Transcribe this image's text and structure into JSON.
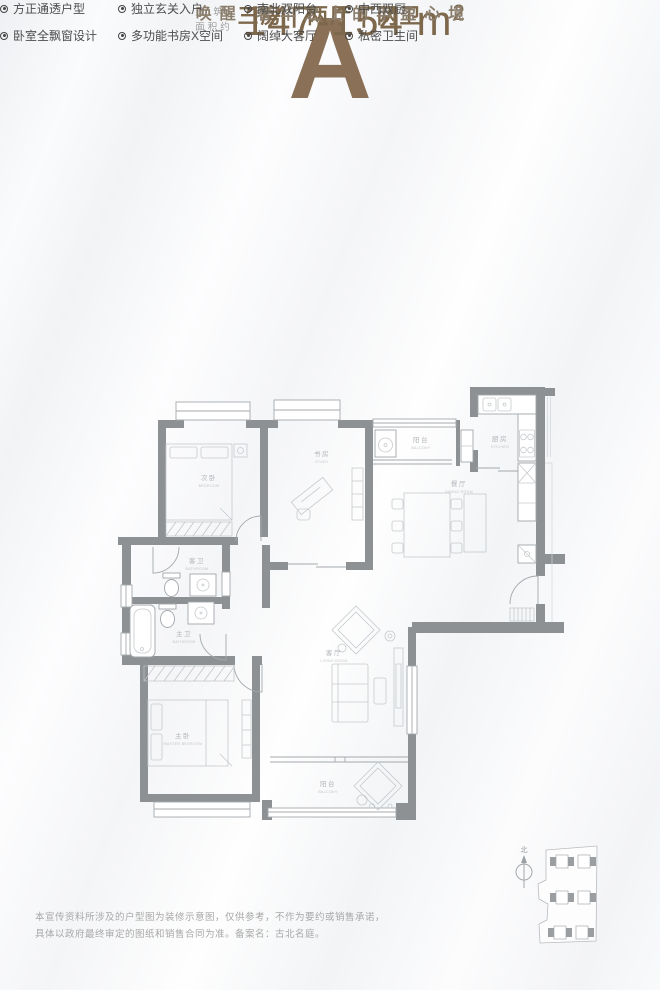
{
  "colors": {
    "brand_brown": "#8a7057",
    "number_brown": "#7d684c",
    "tagline_brown": "#8a7d6c",
    "feature_text": "#4d4d4d",
    "wall_gray": "#8d9193",
    "plan_label_gray": "#b2b6ba",
    "disclaimer_gray": "#a8a8a8"
  },
  "header": {
    "plan_letter": "A",
    "area_label_line1": "建 筑",
    "area_label_line2": "面积约",
    "area_value": "147-154 m",
    "area_unit_sup": "2",
    "layout_line": "三房 | 两厅 | 两卫",
    "tagline": "唤醒 奢华之上的丰盈心境"
  },
  "features": [
    {
      "label": "方正通透户型"
    },
    {
      "label": "独立玄关入户"
    },
    {
      "label": "南北双阳台"
    },
    {
      "label": "中西双厨"
    },
    {
      "label": "卧室全飘窗设计"
    },
    {
      "label": "多功能书房X空间"
    },
    {
      "label": "阔绰大客厅"
    },
    {
      "label": "私密卫生间"
    }
  ],
  "floorplan": {
    "rooms": [
      {
        "cn": "次卧",
        "en": "BEDROOM"
      },
      {
        "cn": "书房",
        "en": "STUDY"
      },
      {
        "cn": "阳台",
        "en": "BALCONY"
      },
      {
        "cn": "厨房",
        "en": "KITCHEN"
      },
      {
        "cn": "餐厅",
        "en": "DINING ROOM"
      },
      {
        "cn": "客卫",
        "en": "BATHROOM"
      },
      {
        "cn": "主卫",
        "en": "BATHROOM"
      },
      {
        "cn": "客厅",
        "en": "LIVING ROOM"
      },
      {
        "cn": "主卧",
        "en": "MASTER BEDROOM"
      },
      {
        "cn": "阳台",
        "en": "BALCONY"
      }
    ]
  },
  "siteplan": {
    "compass_label": "北"
  },
  "disclaimer": {
    "line1": "本宣传资料所涉及的户型图为装修示意图，仅供参考，不作为要约或销售承诺，",
    "line2": "具体以政府最终审定的图纸和销售合同为准。备案名：古北名庭。"
  }
}
